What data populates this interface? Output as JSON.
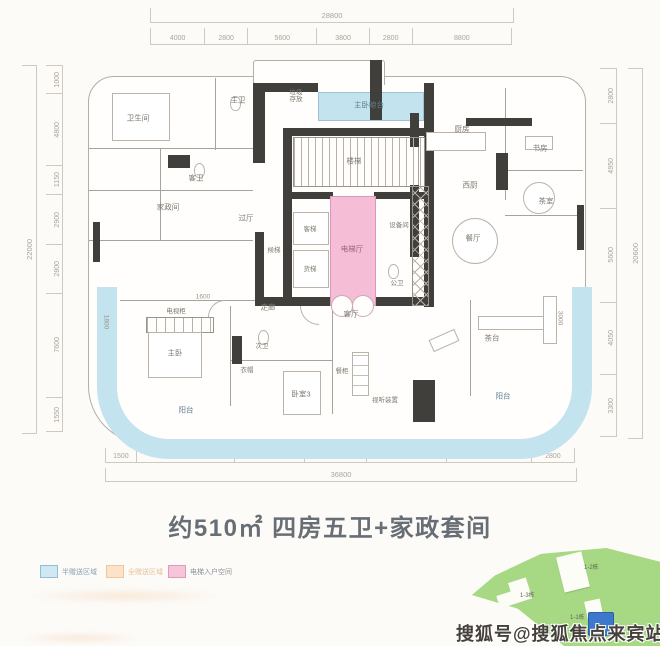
{
  "title": "约510㎡ 四房五卫+家政套间",
  "dims": {
    "top": {
      "total": "28800",
      "segments": [
        "4000",
        "2800",
        "5600",
        "3800",
        "2800",
        "8800"
      ]
    },
    "bottom": {
      "total": "36800",
      "segments": [
        "1500",
        "8550",
        "5600",
        "4800",
        "6650",
        "7200",
        "2800"
      ]
    },
    "left": {
      "total": "22000",
      "segments": [
        "1000",
        "4800",
        "1150",
        "2900",
        "2800",
        "7600",
        "1550"
      ]
    },
    "right": {
      "total": "20600",
      "segments": [
        "2800",
        "4950",
        "5600",
        "4050",
        "3300"
      ]
    },
    "inline": {
      "left_balcony": "1800",
      "right_balcony": "3000",
      "closet": "1600"
    }
  },
  "rooms": {
    "bath_top": "卫生间",
    "master_bath": "主卫",
    "trash": "垃圾存放",
    "master_balcony": "主卧晾台",
    "stairs": "楼梯",
    "kitchen": "厨房",
    "study": "书房",
    "tea_room": "茶室",
    "west_kitchen": "西厨",
    "dining": "餐厅",
    "hall": "过厅",
    "lift_lobby": "候梯",
    "lift_a": "客梯",
    "lift_b": "货梯",
    "equipment": "设备间",
    "public_bath": "公卫",
    "elevator_hall": "电梯厅",
    "living": "客厅",
    "housekeeping": "家政间",
    "guest_bath": "客卫",
    "corridor": "走廊",
    "second_bath": "次卫",
    "cloak": "衣帽",
    "bedroom3": "卧室3",
    "tv_cabinet": "电视柜",
    "master_bed": "主卧",
    "balcony_left": "阳台",
    "balcony_right": "阳台",
    "tea_table": "茶台",
    "cabinet": "餐柜",
    "av": "视听装置"
  },
  "legend": {
    "items": [
      {
        "label": "半赠送区域",
        "fill": "#cfe8f3",
        "border": "#8fbfd4",
        "text": "#86a0ae"
      },
      {
        "label": "全赠送区域",
        "fill": "#fbe3c8",
        "border": "#eec79d",
        "text": "#e6c096"
      },
      {
        "label": "电梯入户空间",
        "fill": "#f7c4da",
        "border": "#dd9cbd",
        "text": "#8b9199"
      }
    ]
  },
  "keymap": {
    "buildings": [
      "1-2栋",
      "1-3栋",
      "1-1栋"
    ]
  },
  "watermark": "搜狐号@搜狐焦点来宾站",
  "colors": {
    "gift_blue": "#c3e3ef",
    "elevator_pink": "#f5bed6",
    "site_green": "#a7d884",
    "current_building_blue": "#3c78cc",
    "wall_dark": "#413f3b"
  }
}
